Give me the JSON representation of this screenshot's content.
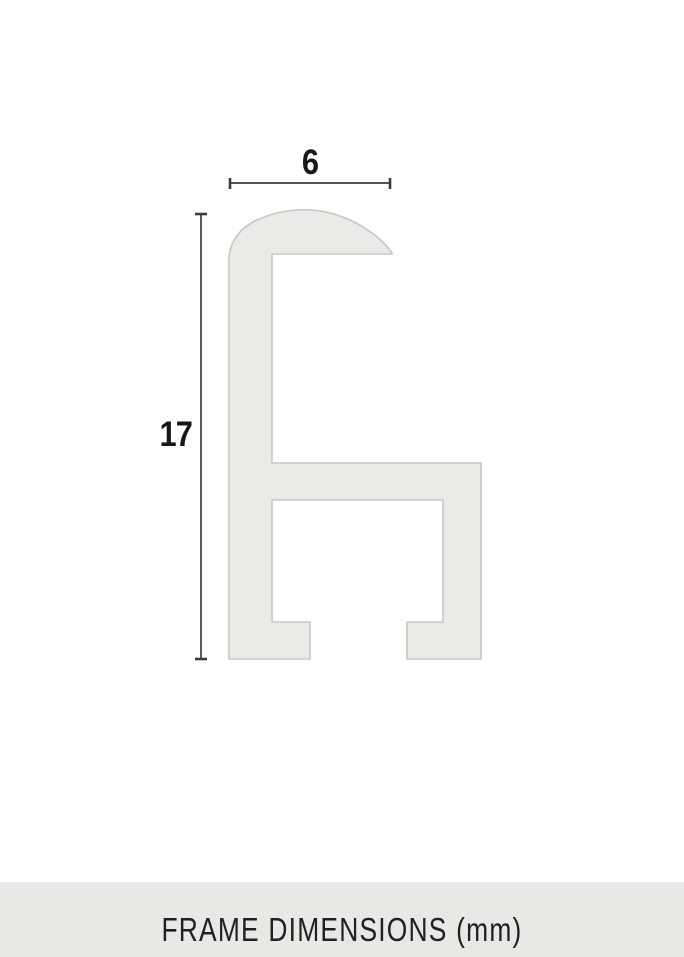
{
  "diagram": {
    "width_dimension": {
      "label": "6"
    },
    "height_dimension": {
      "label": "17"
    },
    "unit": "mm"
  },
  "footer": {
    "label": "FRAME DIMENSIONS (mm)"
  },
  "colors": {
    "page_bg": "#ffffff",
    "profile_fill": "#eaeae6",
    "profile_stroke": "#c7c7c4",
    "dimension_line": "#3d3d3d",
    "label_text": "#191817",
    "footer_bg": "#e8e8e4",
    "footer_text": "#222120"
  }
}
